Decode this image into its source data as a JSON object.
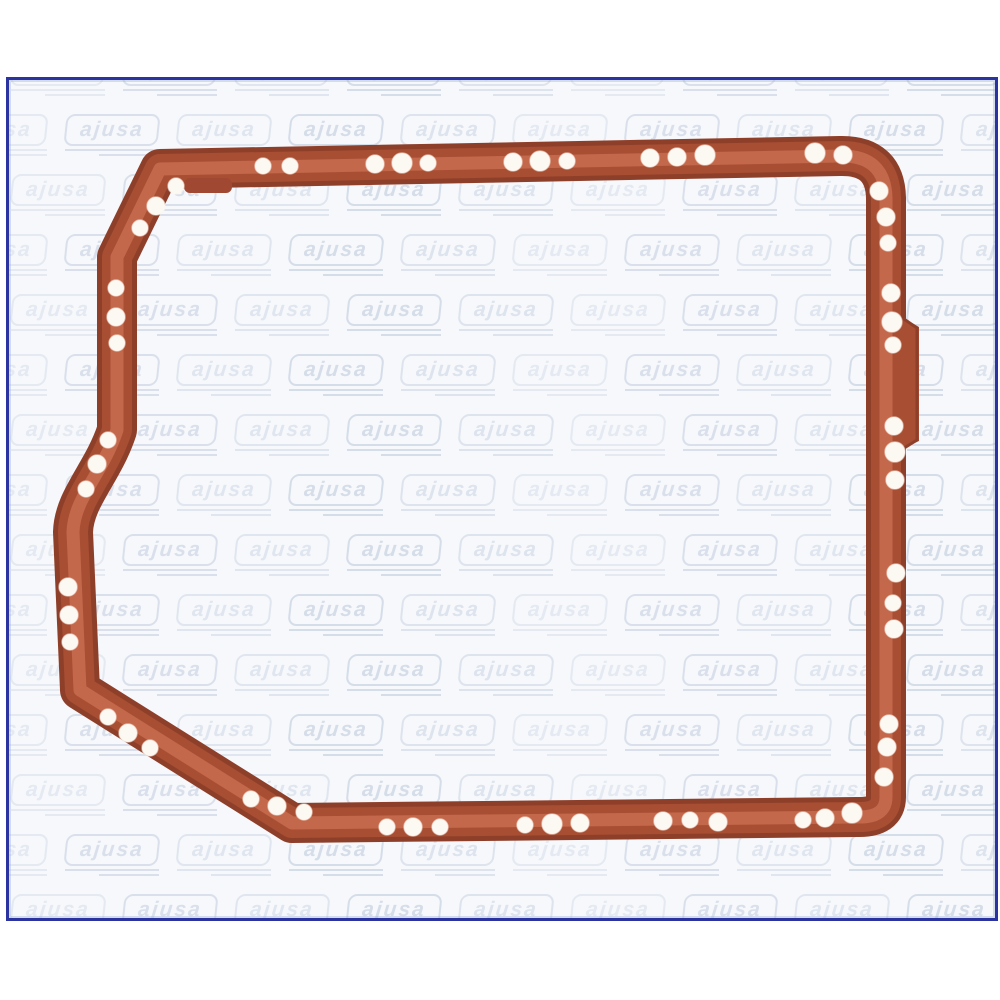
{
  "page": {
    "background": "#ffffff"
  },
  "frame": {
    "left": 6,
    "top": 77,
    "width": 992,
    "height": 844,
    "border_color": "#2a33a0",
    "border_width": 3,
    "inner_line_color": "rgba(130,155,205,0.30)",
    "background": "#f6f8fb"
  },
  "watermark": {
    "text": "ajusa",
    "color": "rgba(150,170,200,0.42)",
    "tile_pitch_x": 112,
    "tile_pitch_y": 60,
    "rows": 15,
    "cols": 11,
    "row_offset": -58,
    "start_y": -26,
    "start_x": 2,
    "box_width": 94,
    "box_height": 32,
    "font_size": 21,
    "line2_width": 60,
    "line2_indent": 34
  },
  "gasket": {
    "outline_path": "M 160 169 L 840 156 Q 885 155 886 198 L 886 797 Q 886 818 857 817 L 292 823 L 80 690 L 73 532 C 74 498 103 473 117 430 L 117 257 Z",
    "stroke_passes": [
      {
        "width": 40,
        "color": "#8e3f2a"
      },
      {
        "width": 30,
        "color": "#a84e33"
      },
      {
        "width": 13,
        "color": "#c4684b"
      }
    ],
    "side_bump": {
      "fill": "#a84e33",
      "points": "893,312 919,327 919,441 893,453",
      "edge": "M 901 317 L 917 328 L 917 440 L 901 450",
      "edge_color": "#8e3f2a"
    },
    "top_tab": {
      "x": 184,
      "y": 178,
      "width": 48,
      "height": 15,
      "rx": 6,
      "fill": "#a04831"
    },
    "hole_fill": "#fcf8f2",
    "holes": [
      [
        263,
        166,
        8
      ],
      [
        290,
        166,
        8
      ],
      [
        375,
        164,
        9
      ],
      [
        402,
        163,
        10
      ],
      [
        428,
        163,
        8
      ],
      [
        513,
        162,
        9
      ],
      [
        540,
        161,
        10
      ],
      [
        567,
        161,
        8
      ],
      [
        650,
        158,
        9
      ],
      [
        677,
        157,
        9
      ],
      [
        705,
        155,
        10
      ],
      [
        815,
        153,
        10
      ],
      [
        843,
        155,
        9
      ],
      [
        879,
        191,
        9
      ],
      [
        886,
        217,
        9
      ],
      [
        888,
        243,
        8
      ],
      [
        891,
        293,
        9
      ],
      [
        892,
        322,
        10
      ],
      [
        893,
        345,
        8
      ],
      [
        894,
        426,
        9
      ],
      [
        895,
        452,
        10
      ],
      [
        895,
        480,
        9
      ],
      [
        896,
        573,
        9
      ],
      [
        893,
        603,
        8
      ],
      [
        894,
        629,
        9
      ],
      [
        889,
        724,
        9
      ],
      [
        887,
        747,
        9
      ],
      [
        884,
        777,
        9
      ],
      [
        852,
        813,
        10
      ],
      [
        825,
        818,
        9
      ],
      [
        803,
        820,
        8
      ],
      [
        718,
        822,
        9
      ],
      [
        690,
        820,
        8
      ],
      [
        663,
        821,
        9
      ],
      [
        580,
        823,
        9
      ],
      [
        552,
        824,
        10
      ],
      [
        525,
        825,
        8
      ],
      [
        440,
        827,
        8
      ],
      [
        413,
        827,
        9
      ],
      [
        387,
        827,
        8
      ],
      [
        304,
        812,
        8
      ],
      [
        277,
        806,
        9
      ],
      [
        251,
        799,
        8
      ],
      [
        150,
        748,
        8
      ],
      [
        128,
        733,
        9
      ],
      [
        108,
        717,
        8
      ],
      [
        70,
        642,
        8
      ],
      [
        69,
        615,
        9
      ],
      [
        68,
        587,
        9
      ],
      [
        86,
        489,
        8
      ],
      [
        97,
        464,
        9
      ],
      [
        108,
        440,
        8
      ],
      [
        117,
        343,
        8
      ],
      [
        116,
        317,
        9
      ],
      [
        116,
        288,
        8
      ],
      [
        140,
        228,
        8
      ],
      [
        156,
        206,
        9
      ],
      [
        176,
        186,
        8
      ]
    ]
  }
}
